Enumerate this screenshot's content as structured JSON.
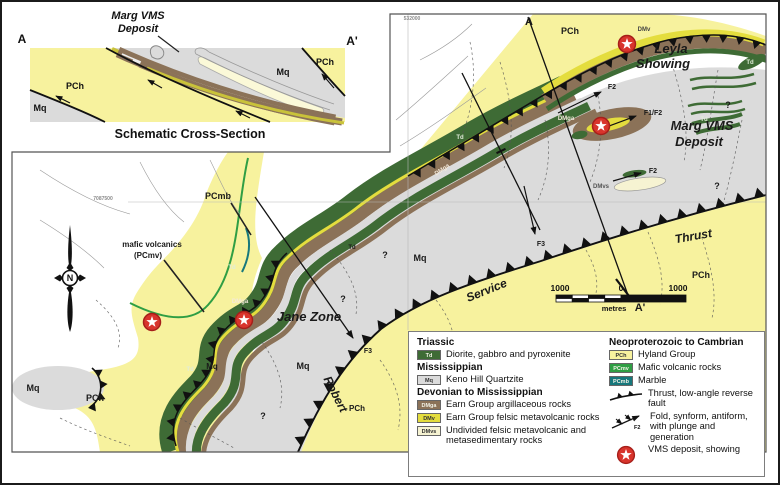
{
  "colors": {
    "pch": "#F7F29E",
    "dmv": "#E4DD3E",
    "dmvs": "#F6F3D2",
    "dmga": "#8B7258",
    "td": "#3E6B35",
    "pcmv": "#2F9E44",
    "pcmb": "#17787C",
    "mq": "#DBDBDB",
    "star_red": "#D8342C",
    "star_ring": "#A61F1A"
  },
  "xsection": {
    "deposit_line1": "Marg VMS",
    "deposit_line2": "Deposit",
    "a": "A",
    "a_prime": "A'",
    "pch_left": "PCh",
    "mq_bottom_left": "Mq",
    "mq_right": "Mq",
    "pch_right": "PCh",
    "title": "Schematic Cross-Section"
  },
  "map": {
    "north_letter": "N",
    "scalebar": {
      "left": "1000",
      "zero": "0",
      "right": "1000",
      "unit": "metres"
    },
    "unit_labels": [
      {
        "t": "PCh",
        "x": 570,
        "y": 34,
        "s": 9
      },
      {
        "t": "DMv",
        "x": 644,
        "y": 31,
        "s": 6,
        "c": "#444"
      },
      {
        "t": "Td",
        "x": 750,
        "y": 64,
        "s": 6,
        "c": "#e0ecd8"
      },
      {
        "t": "Td",
        "x": 704,
        "y": 121,
        "s": 6,
        "c": "#e0ecd8"
      },
      {
        "t": "Td",
        "x": 460,
        "y": 139,
        "s": 6,
        "c": "#e0ecd8"
      },
      {
        "t": "Td",
        "x": 352,
        "y": 249,
        "s": 6
      },
      {
        "t": "Td",
        "x": 232,
        "y": 269,
        "s": 6,
        "c": "#e0ecd8"
      },
      {
        "t": "Td",
        "x": 190,
        "y": 371,
        "s": 6,
        "c": "#e0ecd8"
      },
      {
        "t": "DMga",
        "x": 566,
        "y": 120,
        "s": 6,
        "c": "#f3e9da"
      },
      {
        "t": "DMga",
        "x": 443,
        "y": 171,
        "s": 6,
        "c": "#f3e9da",
        "r": -35
      },
      {
        "t": "DMga",
        "x": 240,
        "y": 303,
        "s": 6,
        "c": "#f3e9da"
      },
      {
        "t": "DMvs",
        "x": 601,
        "y": 188,
        "s": 6,
        "c": "#555"
      },
      {
        "t": "F1/F2",
        "x": 653,
        "y": 115,
        "s": 7
      },
      {
        "t": "F2",
        "x": 612,
        "y": 89,
        "s": 7
      },
      {
        "t": "F2",
        "x": 653,
        "y": 173,
        "s": 7
      },
      {
        "t": "F3",
        "x": 541,
        "y": 246,
        "s": 7
      },
      {
        "t": "F3",
        "x": 368,
        "y": 353,
        "s": 7
      },
      {
        "t": "?",
        "x": 728,
        "y": 108,
        "s": 9
      },
      {
        "t": "?",
        "x": 717,
        "y": 189,
        "s": 9
      },
      {
        "t": "?",
        "x": 385,
        "y": 258,
        "s": 9
      },
      {
        "t": "?",
        "x": 343,
        "y": 302,
        "s": 9
      },
      {
        "t": "?",
        "x": 263,
        "y": 419,
        "s": 9
      },
      {
        "t": "Mq",
        "x": 420,
        "y": 261,
        "s": 9
      },
      {
        "t": "Mq",
        "x": 303,
        "y": 369,
        "s": 9
      },
      {
        "t": "Mq",
        "x": 212,
        "y": 369,
        "s": 8
      },
      {
        "t": "Mq",
        "x": 33,
        "y": 391,
        "s": 9
      },
      {
        "t": "PCh",
        "x": 701,
        "y": 278,
        "s": 9
      },
      {
        "t": "PCh",
        "x": 95,
        "y": 401,
        "s": 9
      },
      {
        "t": "PCh",
        "x": 357,
        "y": 411,
        "s": 8
      },
      {
        "t": "PCmb",
        "x": 218,
        "y": 199,
        "s": 9
      },
      {
        "t": "7087500",
        "x": 103,
        "y": 200,
        "s": 5,
        "c": "#8a8a8a"
      },
      {
        "t": "532000",
        "x": 412,
        "y": 20,
        "s": 5,
        "c": "#8a8a8a"
      }
    ],
    "feature_labels": [
      {
        "t": "Leyla",
        "x": 671,
        "y": 53,
        "s": 13
      },
      {
        "t": "Showing",
        "x": 663,
        "y": 68,
        "s": 13
      },
      {
        "t": "Marg VMS",
        "x": 702,
        "y": 130,
        "s": 13
      },
      {
        "t": "Deposit",
        "x": 699,
        "y": 146,
        "s": 13
      },
      {
        "t": "Jane Zone",
        "x": 309,
        "y": 321,
        "s": 13
      },
      {
        "t": "Thrust",
        "x": 694,
        "y": 240,
        "s": 12,
        "r": -10
      },
      {
        "t": "Service",
        "x": 488,
        "y": 294,
        "s": 12,
        "r": -22
      },
      {
        "t": "Robert",
        "x": 332,
        "y": 396,
        "s": 12,
        "r": 63
      },
      {
        "t": "A",
        "x": 529,
        "y": 25,
        "s": 11,
        "plain": true
      },
      {
        "t": "A'",
        "x": 640,
        "y": 311,
        "s": 11,
        "plain": true
      },
      {
        "t": "mafic volcanics",
        "x": 152,
        "y": 247,
        "s": 8,
        "plain": true
      },
      {
        "t": "(PCmv)",
        "x": 148,
        "y": 258,
        "s": 8,
        "plain": true
      }
    ],
    "stars": [
      {
        "x": 627,
        "y": 44
      },
      {
        "x": 601,
        "y": 126
      },
      {
        "x": 244,
        "y": 320
      },
      {
        "x": 152,
        "y": 322
      }
    ]
  },
  "legend": {
    "col1_sections": [
      {
        "title": "Triassic",
        "items": [
          {
            "code": "Td",
            "color": "td",
            "light": true,
            "text": "Diorite, gabbro and pyroxenite"
          }
        ]
      },
      {
        "title": "Mississippian",
        "items": [
          {
            "code": "Mq",
            "color": "mq",
            "text": "Keno Hill Quartzite"
          }
        ]
      },
      {
        "title": "Devonian to Mississippian",
        "items": [
          {
            "code": "DMga",
            "color": "dmga",
            "light": true,
            "text": "Earn Group argillaceous rocks"
          },
          {
            "code": "DMv",
            "color": "dmv",
            "text": "Earn Group felsic metavolcanic rocks"
          },
          {
            "code": "DMvs",
            "color": "dmvs",
            "text": "Undivided felsic metavolcanic and metasedimentary rocks"
          }
        ]
      }
    ],
    "col2_sections": [
      {
        "title": "Neoproterozoic to Cambrian",
        "items": [
          {
            "code": "PCh",
            "color": "pch",
            "text": "Hyland Group"
          },
          {
            "code": "PCmv",
            "color": "pcmv",
            "light": true,
            "text": "Mafic volcanic rocks"
          },
          {
            "code": "PCmb",
            "color": "pcmb",
            "light": true,
            "text": "Marble"
          }
        ]
      }
    ],
    "symbols": [
      {
        "type": "thrust",
        "text": "Thrust, low-angle reverse fault"
      },
      {
        "type": "fold",
        "tag": "F2",
        "text": "Fold, synform, antiform, with plunge and generation"
      },
      {
        "type": "star",
        "text": "VMS deposit, showing"
      }
    ]
  }
}
